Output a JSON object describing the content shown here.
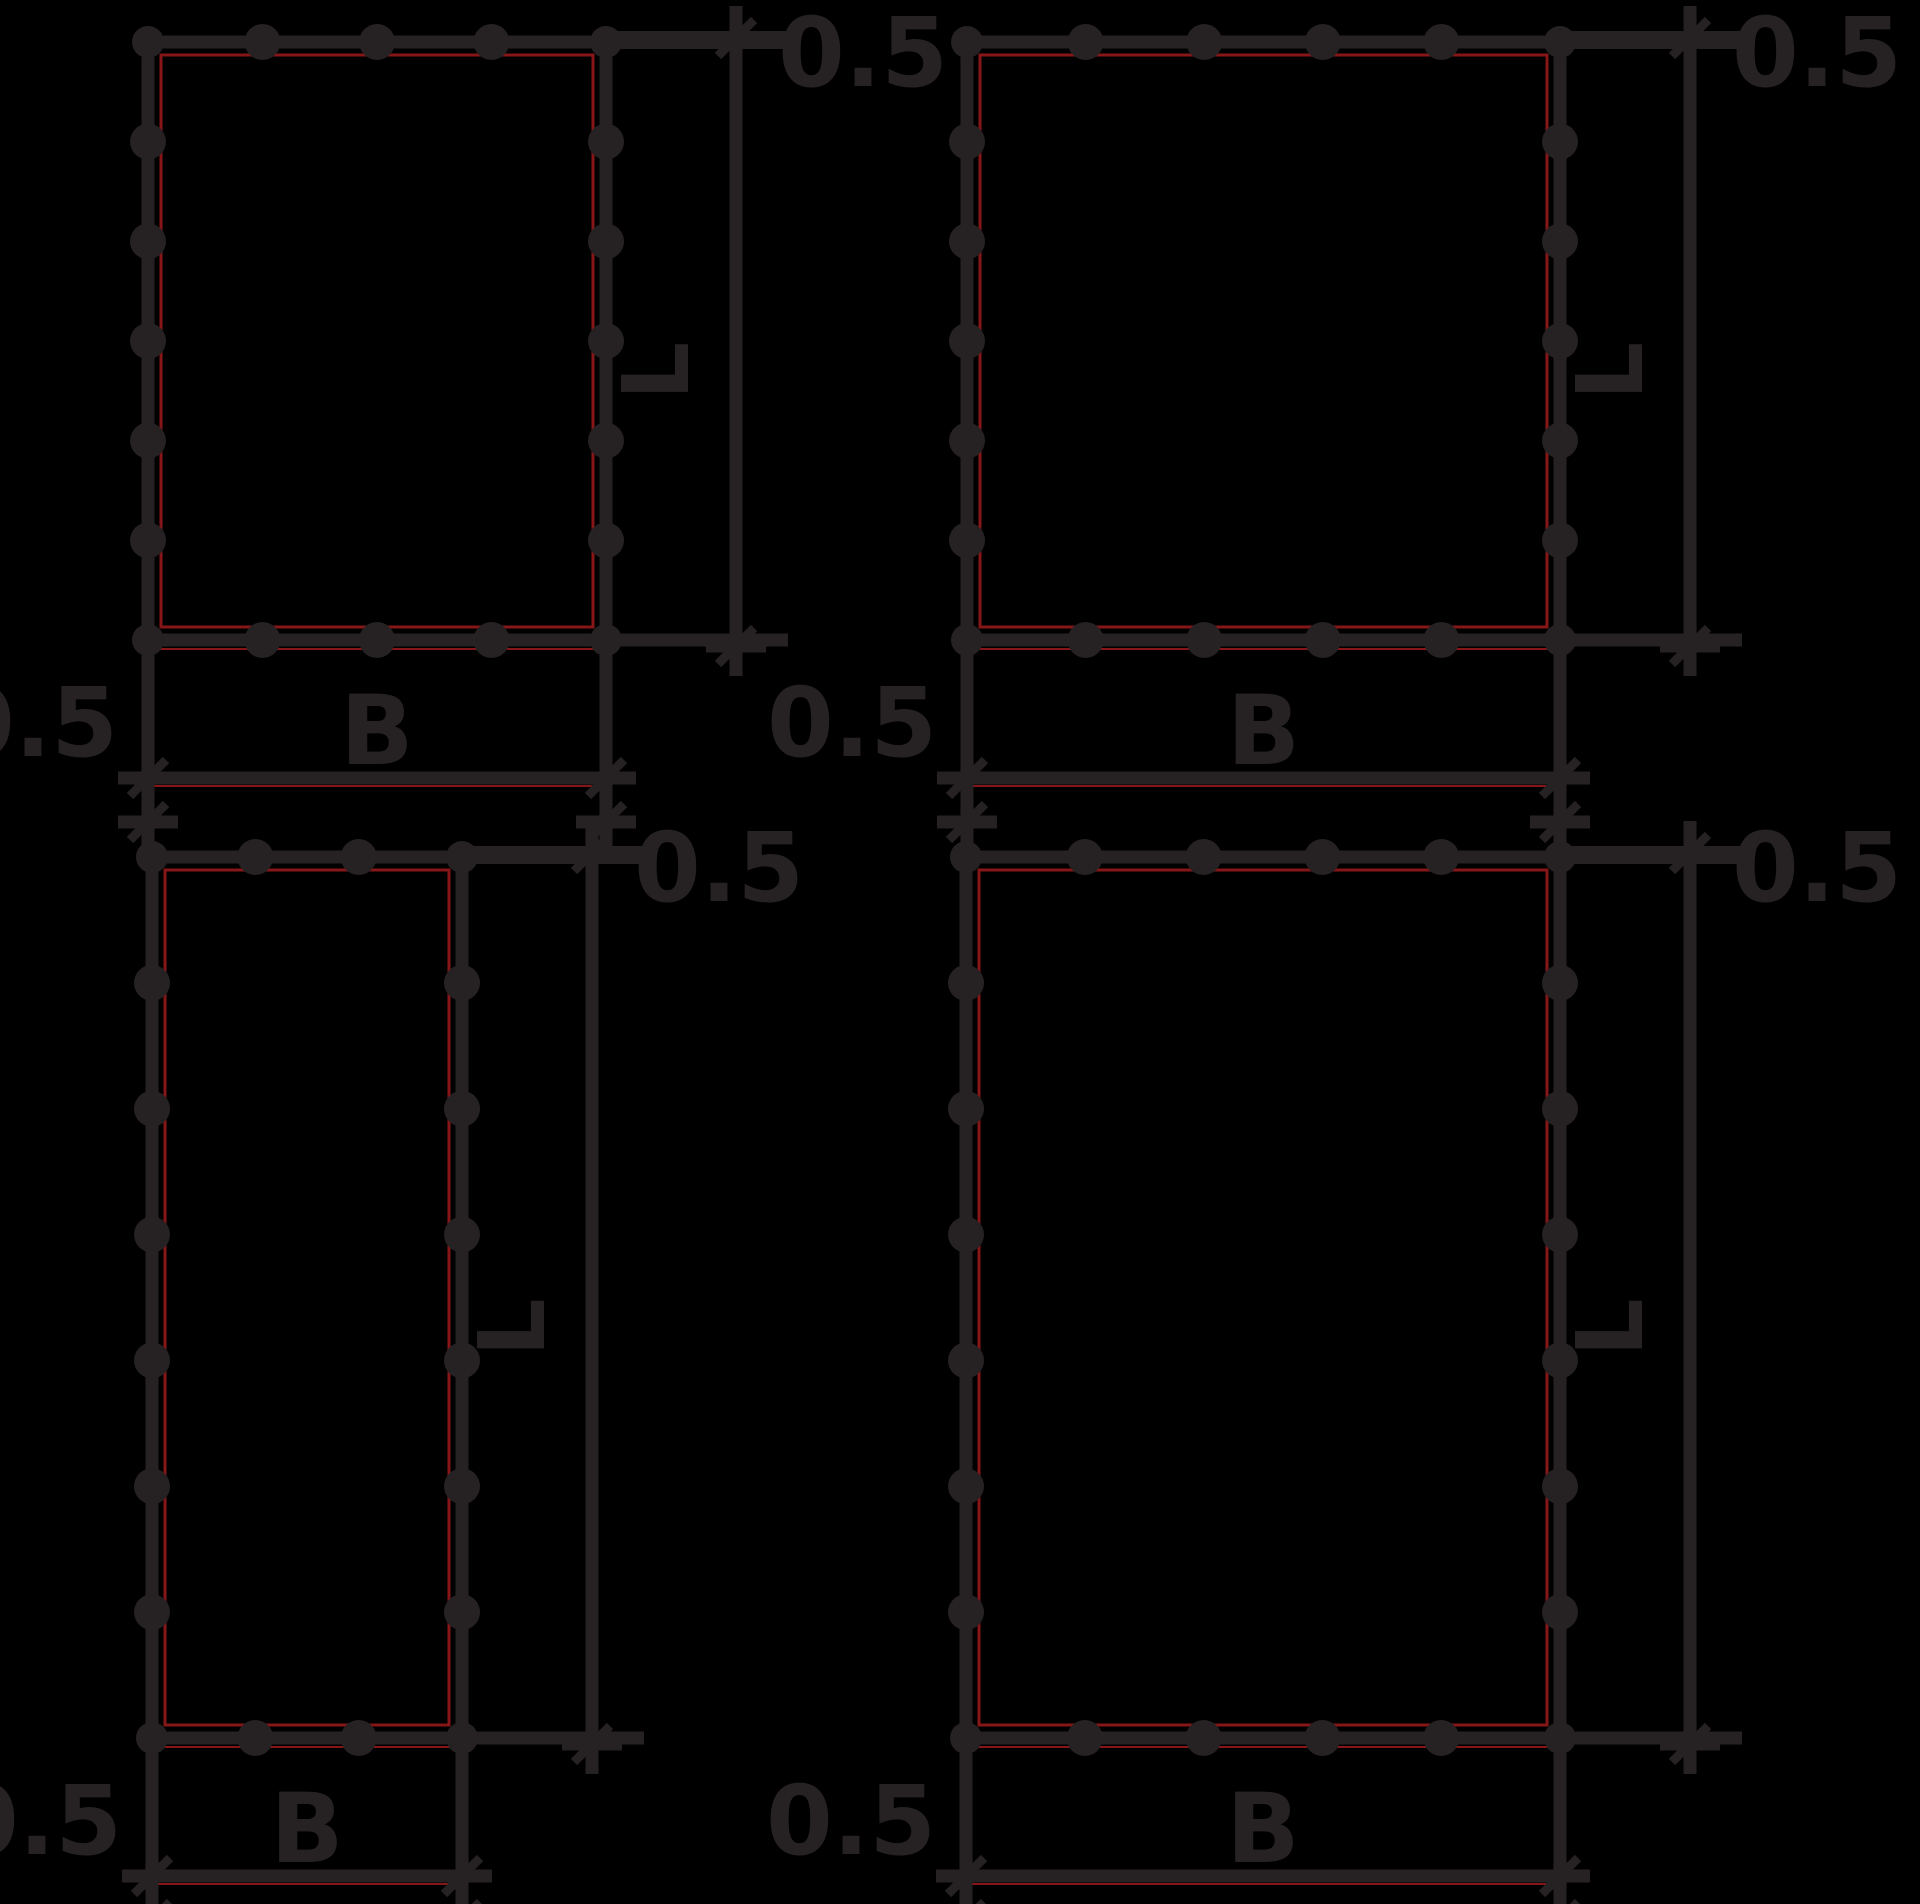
{
  "canvas": {
    "width": 1920,
    "height": 1904,
    "background": "#000000"
  },
  "style": {
    "ink": "#262223",
    "seam_red": "#871619",
    "line_width": 13,
    "ext_bar_width": 18,
    "seam_width": 3,
    "bump_radius": 18,
    "corner_radius": 16,
    "font_dimension": 96,
    "font_length": 92
  },
  "labels": {
    "offset": "0.5",
    "width": "B",
    "length": "L"
  },
  "dims": {
    "ldim_offset": 130,
    "bdim_offset": 138,
    "ext_past": 52,
    "overshoot": 36,
    "offset_text_gap": 42,
    "offset_text_baseline": 44,
    "b_label_baseline": 14,
    "bottom_offset_baseline": 22,
    "l_label_gap": 48
  },
  "panels": [
    {
      "name": "top-left",
      "x": 148,
      "y": 42,
      "w": 458,
      "h": 598,
      "bumps": {
        "top": 3,
        "bottom": 3,
        "left": 5,
        "right": 5
      },
      "length_label": "L",
      "width_label": "B",
      "offset_top": "0.5",
      "offset_bottom": "0.5"
    },
    {
      "name": "top-right",
      "x": 967,
      "y": 42,
      "w": 593,
      "h": 598,
      "bumps": {
        "top": 4,
        "bottom": 4,
        "left": 5,
        "right": 5
      },
      "length_label": "L",
      "width_label": "B",
      "offset_top": "0.5",
      "offset_bottom": "0.5"
    },
    {
      "name": "bottom-left",
      "x": 152,
      "y": 857,
      "w": 310,
      "h": 881,
      "bumps": {
        "top": 2,
        "bottom": 2,
        "left": 6,
        "right": 6
      },
      "length_label": "L",
      "width_label": "B",
      "offset_top": "0.5",
      "offset_bottom": "0.5"
    },
    {
      "name": "bottom-right",
      "x": 966,
      "y": 857,
      "w": 594,
      "h": 881,
      "bumps": {
        "top": 4,
        "bottom": 4,
        "left": 6,
        "right": 6
      },
      "length_label": "L",
      "width_label": "B",
      "offset_top": "0.5",
      "offset_bottom": "0.5"
    }
  ]
}
